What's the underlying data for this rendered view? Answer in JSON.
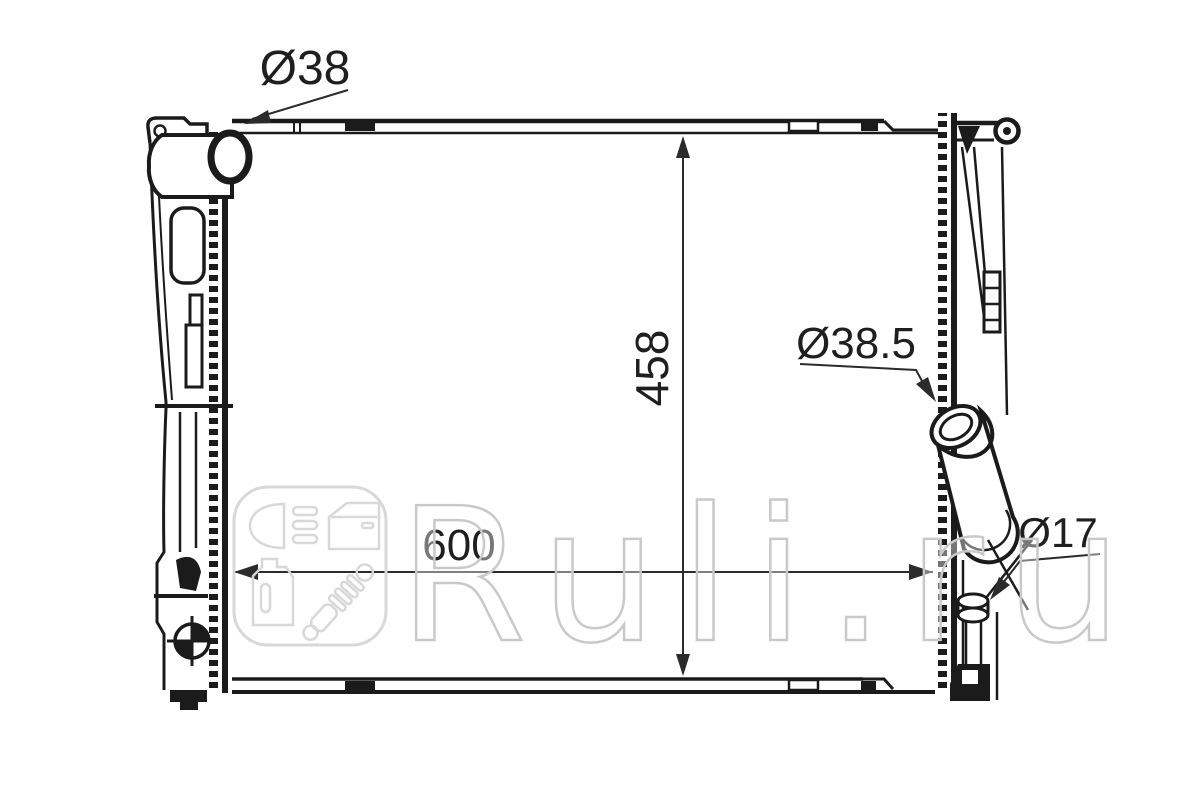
{
  "drawing": {
    "part": "radiator-technical-drawing",
    "dimensions": {
      "inlet_pipe_label": "Ø38",
      "outlet_pipe_label": "Ø38.5",
      "drain_fitting_label": "Ø17",
      "core_height_label": "458",
      "core_width_label": "600"
    },
    "colors": {
      "line": "#1b1b1b",
      "dimension_line": "#2b2b2b",
      "watermark_stroke": "#c9c9c9",
      "background": "#ffffff"
    }
  },
  "watermark": {
    "text": "Ruli.ru",
    "logo_icons": [
      "headlight-icon",
      "car-door-icon",
      "oil-canister-icon",
      "shock-absorber-icon"
    ]
  }
}
